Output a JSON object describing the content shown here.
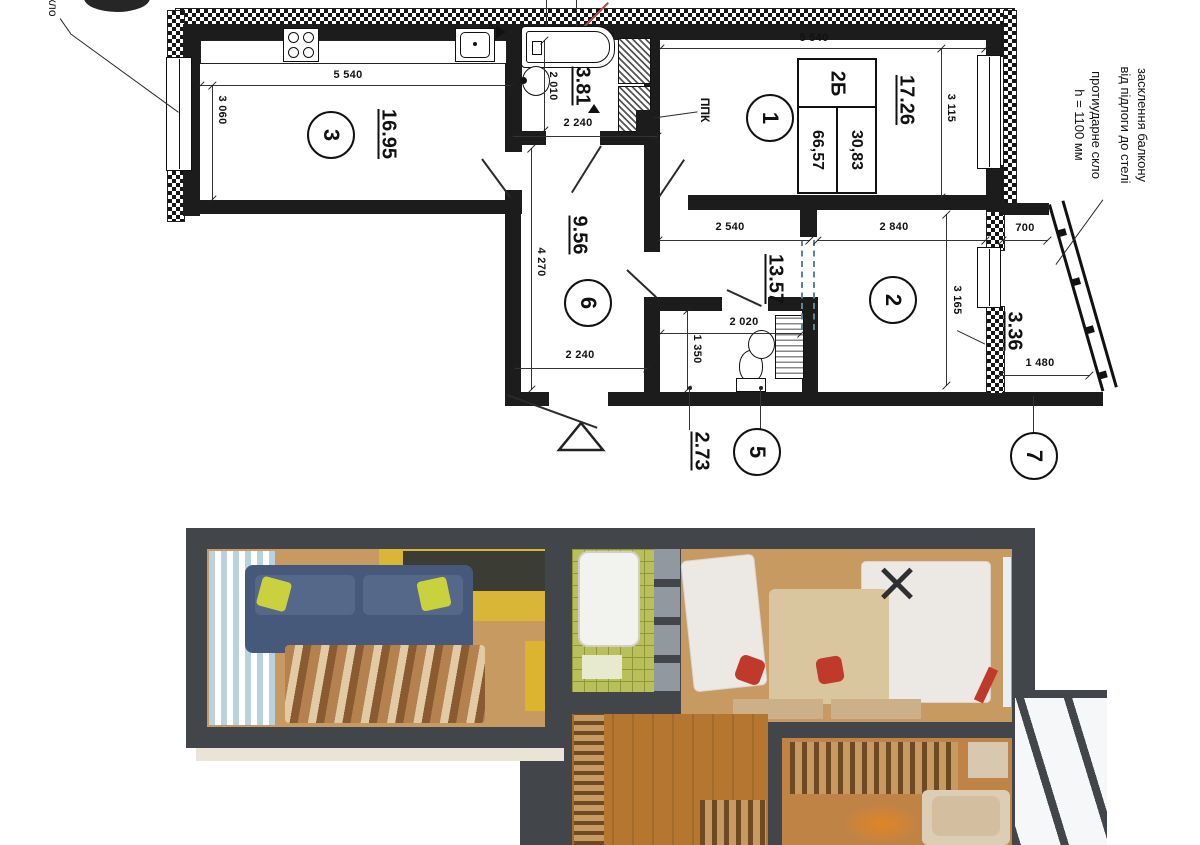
{
  "plan": {
    "stamp": {
      "type": "2Б",
      "living": "30,83",
      "total": "66,57"
    },
    "areas": {
      "kitchen": "16.95",
      "bathroom": "3.81",
      "room1": "17.26",
      "hallway": "9.56",
      "bedroom": "13.57",
      "wc": "2.73",
      "balcony": "3.36"
    },
    "circles": {
      "c1": "1",
      "c2": "2",
      "c3": "3",
      "c5": "5",
      "c6": "6",
      "c7": "7"
    },
    "dimensions": {
      "kitchen_width": "5 540",
      "kitchen_depth": "3 060",
      "room1_width": "5 540",
      "room1_depth": "3 115",
      "bath_depth": "2 010",
      "bath_width": "2 240",
      "zone_width": "2 540",
      "bedroom_width": "2 840",
      "bedroom_depth": "3 165",
      "balcony_top": "700",
      "balcony_bottom": "1 480",
      "hall_depth": "4 270",
      "hall_width": "2 240",
      "wc_width": "2 020",
      "wc_depth": "1 350"
    },
    "annotations": {
      "glazing_line1": "засклення балкону",
      "glazing_line2": "від підлоги до стелі",
      "glass_line1": "протиударне скло",
      "glass_line2": "h = 1100 мм",
      "ppk": "ППК",
      "corner_partial": "скло"
    }
  },
  "render": {
    "colors": {
      "wall": "#42454a",
      "wood": "#c79a62",
      "wood2": "#b5772f",
      "wood3": "#c08346",
      "yellow": "#d9b637",
      "sofa": "#46597b",
      "pillow": "#c9d13f",
      "curtain": "#b8d2de",
      "bathtile": "#b9c05a",
      "bathgrid": "#8e9838",
      "gray": "#9298a0",
      "bed": "#ece9e4",
      "chair": "#c03a2c",
      "rugtan": "#d9c59e",
      "slat": "#6d4a22",
      "pane": "#f5f7f8",
      "lamp": "#e08524",
      "shadow": "#eae4d6",
      "island": "#ddb42f"
    }
  }
}
